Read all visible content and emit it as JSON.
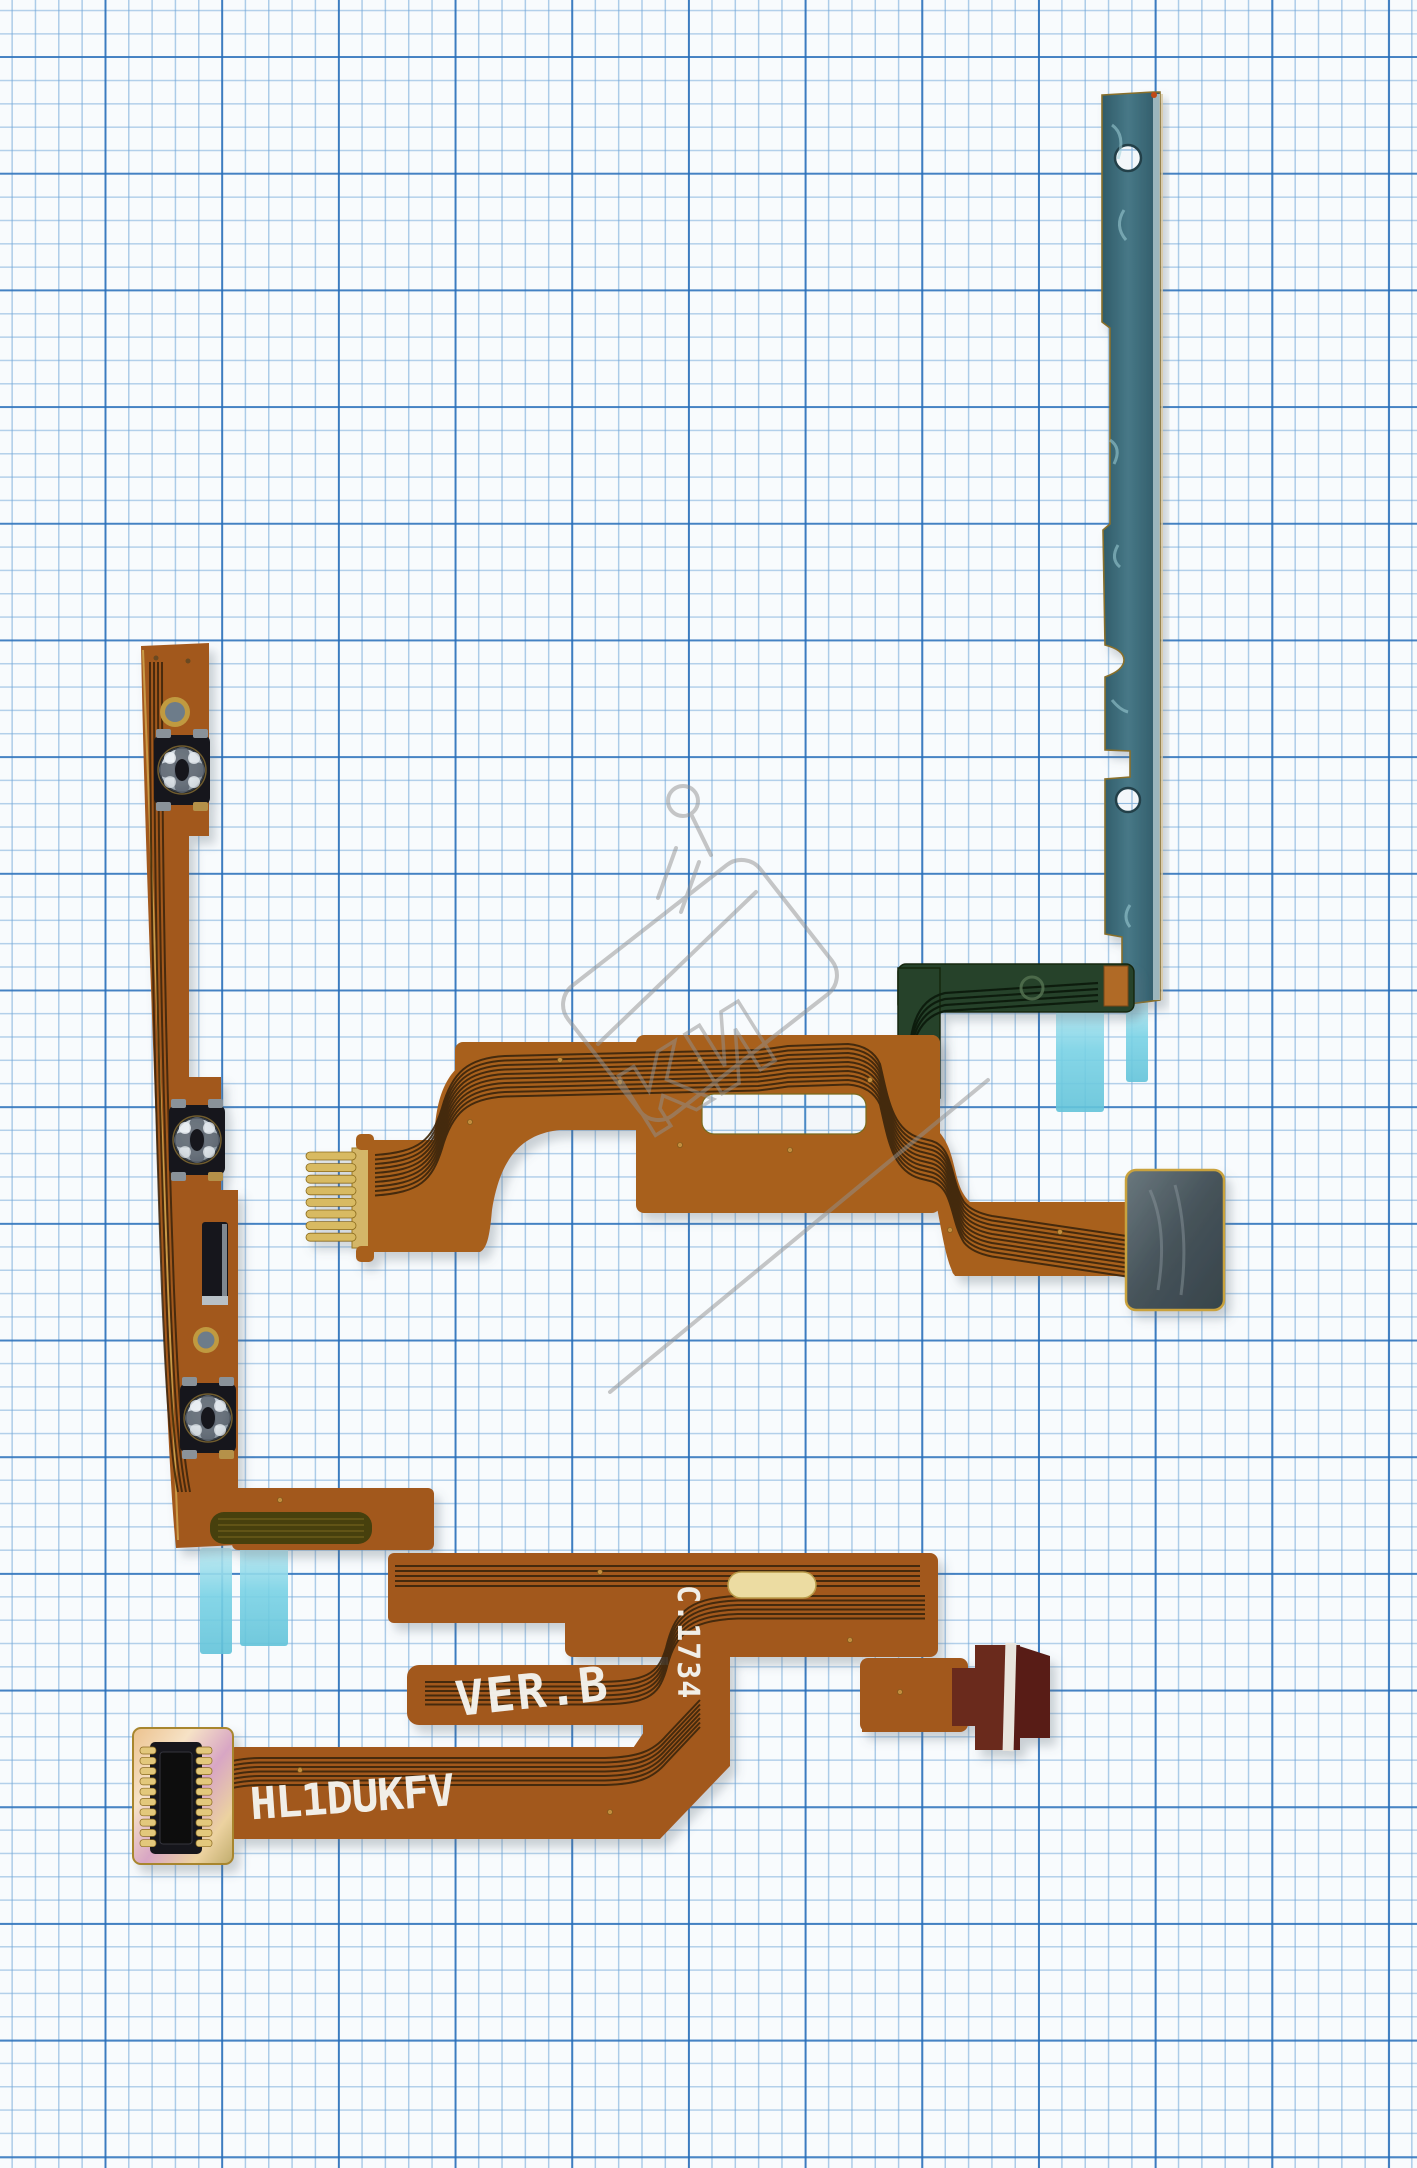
{
  "photo": {
    "subject": "phone side-button and power flex cable set on blue graph paper",
    "pieces": [
      "volume-power flex with three metal dome buttons",
      "main interconnect flex with gold finger connector and shielded pad",
      "steel mounting bracket with adhesive tapes",
      "dark green stub flex",
      "board-to-board connector"
    ]
  },
  "markings": {
    "model": "HL1DUKFV",
    "version": "VER.B",
    "batch": "C.1734"
  },
  "watermark": {
    "letters": "КИ"
  },
  "colors": {
    "flex_copper": "#a2591f",
    "trace_dark": "#3a2407",
    "gold_finger": "#d4b668",
    "bracket_teal": "#3d6b7a",
    "tape_blue": "#74cfe3",
    "green_flex": "#26422c",
    "paper_major_line": "#2e6eb9",
    "paper_minor_line": "#6ea5d7",
    "marking_print": "#f4f3ee"
  }
}
